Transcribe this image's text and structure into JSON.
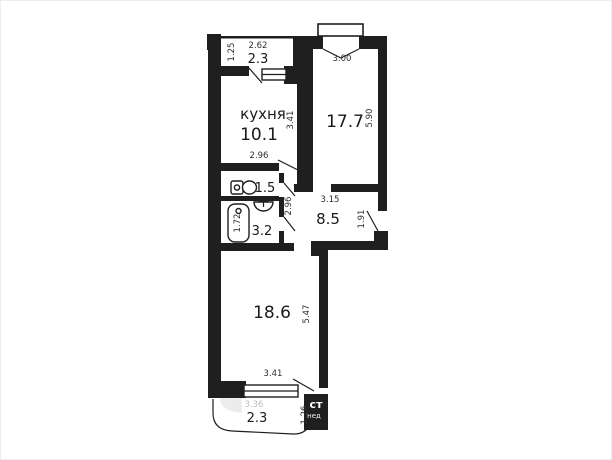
{
  "plan_type": "apartment-floor-plan",
  "rooms": {
    "balcony_top": {
      "area": "2.3"
    },
    "kitchen": {
      "name": "кухня",
      "area": "10.1"
    },
    "living": {
      "area": "17.7"
    },
    "wc": {
      "area": "1.5"
    },
    "bath": {
      "area": "3.2"
    },
    "hall": {
      "area": "8.5"
    },
    "bedroom": {
      "area": "18.6"
    },
    "balcony_bottom": {
      "area": "2.3"
    }
  },
  "dims": {
    "balcony_top_w": "2.62",
    "balcony_top_h": "1.25",
    "living_w": "3.00",
    "living_h": "5.90",
    "kitchen_w": "2.96",
    "kitchen_h": "3.41",
    "corridor_h": "2.96",
    "hall_w": "3.15",
    "entry_h": "1.91",
    "bath_h": "1.72",
    "bedroom_h": "5.47",
    "bedroom_w": "3.41",
    "balcony_bottom_w": "3.36",
    "balcony_bottom_h": "1.26"
  },
  "fixtures": [
    "toilet",
    "washbasin",
    "bathtub"
  ],
  "watermark": {
    "big": "ст",
    "small": "нед"
  },
  "colors": {
    "wall": "#1f1f1f",
    "background": "#ffffff",
    "dim_text": "#2e2e2e",
    "faint_text": "#bdbdbd",
    "border": "#ededed"
  }
}
